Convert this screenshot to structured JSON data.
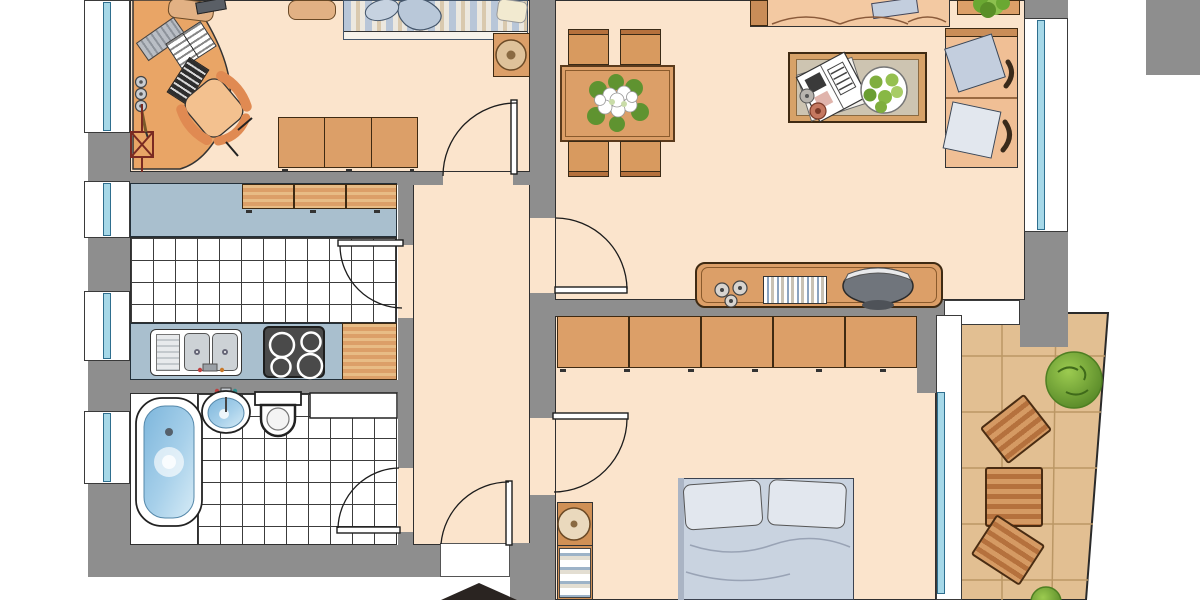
{
  "plan": {
    "title": "Apartment floor plan",
    "rooms": [
      {
        "id": "office-bedroom",
        "label": "Office / bedroom",
        "furniture": [
          "corner desk",
          "desk chair",
          "keyboard",
          "open books",
          "cd tray",
          "cups",
          "pen",
          "coat stand",
          "single bed",
          "blanket",
          "pillow",
          "sideboard",
          "nightstand",
          "round lamp"
        ]
      },
      {
        "id": "kitchen",
        "label": "Kitchen",
        "furniture": [
          "upper cabinets",
          "worktop",
          "double sink with faucet",
          "stove with 4 burners",
          "cutting board",
          "tiled floor"
        ]
      },
      {
        "id": "bathroom",
        "label": "Bathroom",
        "furniture": [
          "bathtub",
          "washbasin",
          "toilet",
          "cabinet",
          "tiled floor"
        ]
      },
      {
        "id": "hallway",
        "label": "Hallway",
        "furniture": []
      },
      {
        "id": "living-dining-room",
        "label": "Living / dining room",
        "furniture": [
          "dining table",
          "four dining chairs",
          "flower centerpiece",
          "sofa",
          "side table with plant",
          "corner sofa with cushions",
          "coffee table",
          "newspaper",
          "fruit plate",
          "coasters",
          "sideboard desk",
          "cd discs",
          "cd rack",
          "large bowl"
        ]
      },
      {
        "id": "bedroom",
        "label": "Bedroom",
        "furniture": [
          "wardrobe row of five doors",
          "double bed with pillows",
          "shelf with books",
          "round stool"
        ]
      },
      {
        "id": "balcony",
        "label": "Balcony",
        "furniture": [
          "slatted garden table",
          "two slatted garden chairs",
          "shrub",
          "shrub at edge"
        ]
      }
    ],
    "doors": [
      {
        "id": "office-door",
        "between": "office-bedroom/hallway"
      },
      {
        "id": "kitchen-door",
        "between": "kitchen/hallway"
      },
      {
        "id": "bathroom-door",
        "between": "bathroom/hallway"
      },
      {
        "id": "living-door",
        "between": "living-dining-room/hallway"
      },
      {
        "id": "bedroom-door",
        "between": "bedroom/hallway"
      },
      {
        "id": "entrance-door",
        "between": "hallway/outside"
      }
    ],
    "windows": [
      "office-left",
      "kitchen-left-upper",
      "kitchen-left-lower",
      "bathroom-left",
      "living-right",
      "bedroom-balcony-door"
    ],
    "entrance": {
      "marker": "black-arrow",
      "direction": "up"
    },
    "palette": {
      "floor": "#fbe4cc",
      "wall": "#8e8e8e",
      "counter": "#a9bfce",
      "wood": "#dc9f68",
      "woodLight": "#e8bc85",
      "woodDark": "#b5713d",
      "woodEdge": "#4a2c12",
      "glass": "#a6d8e8",
      "glassEdge": "#2e6e8e",
      "balcony": "#e2bf92",
      "balconyLine": "#bb9765",
      "plantLight": "#9ccb50",
      "plantDark": "#4e7f22",
      "bedding": "#c9d3e0",
      "pillow": "#e2e7ee",
      "linen": "#c3cede",
      "stove": "#4a4a4a",
      "desk": "#e9a566",
      "sofa": "#f3c9a2",
      "sofaDeep": "#f0bf95",
      "armWood": "#c98d58",
      "waterDeep": "#7db6dc",
      "waterLight": "#d6ebf6",
      "arrow": "#2a2421",
      "ink": "#222222",
      "white": "#ffffff",
      "stripeBlue": "#b8c6d8",
      "stripeTan": "#d9c9ae",
      "stripeCream": "#ece8df"
    }
  }
}
